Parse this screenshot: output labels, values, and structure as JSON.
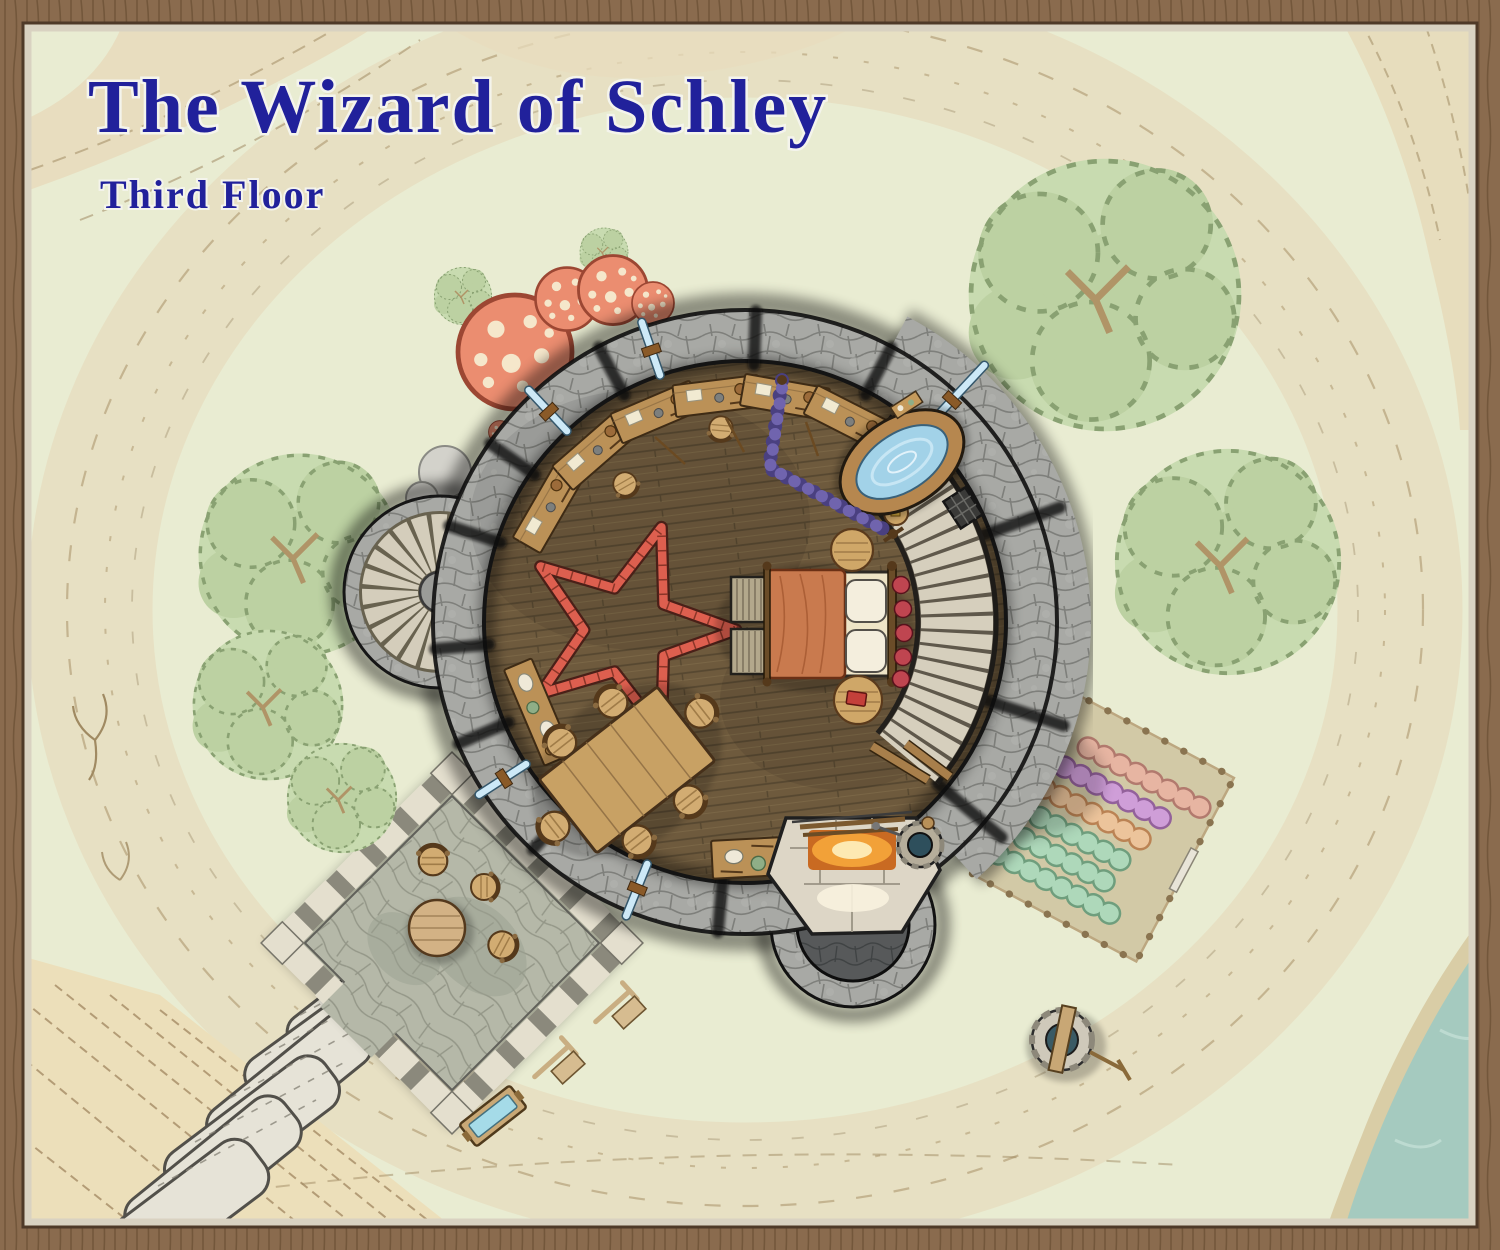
{
  "map": {
    "title": "The Wizard of Schley",
    "subtitle": "Third Floor"
  },
  "palette": {
    "grass": "#e9ecd2",
    "scree_band": "#e7dfc2",
    "cliff_ochre": "#ecdfba",
    "water": "#a5cabf",
    "tree_canopy": "#c8dbb0",
    "wall_stone": "#a8a9a5",
    "floor_wood": "#6e5a3d",
    "stair_tread": "#d6cfbd",
    "pentagram_red": "#dd5f4f",
    "blanket_orange": "#c97a4e",
    "tub_water": "#a2d2e8",
    "mushroom_red": "#eb8d70",
    "screen_purple": "#7064ae",
    "title_blue": "#21219b",
    "frame_wood": "#8a6b4e",
    "garden_rows": [
      "#e7b5a2",
      "#cf9ed8",
      "#ecc49b",
      "#aed8ba",
      "#aed8ba",
      "#aed8ba"
    ]
  },
  "features": [
    "circular tower chamber with plank floor",
    "red summoning pentagram",
    "canopy bed with orange blanket and two pillows",
    "oval wooden hot tub",
    "purple privacy screen",
    "curved stone staircase (east wall)",
    "spiral staircase turret (north-west)",
    "stone hearth with fire and round chimney",
    "small stone cauldron",
    "dining table with six chairs",
    "work desks and sideboard",
    "arrow-slit windows",
    "stone patio with round table and stools",
    "giant stone slab steps",
    "fenced garden with six planted rows and gate",
    "stone well with crank",
    "water trough",
    "giant red mushrooms and boulders",
    "tree canopies",
    "lake shore (south-east corner)"
  ]
}
